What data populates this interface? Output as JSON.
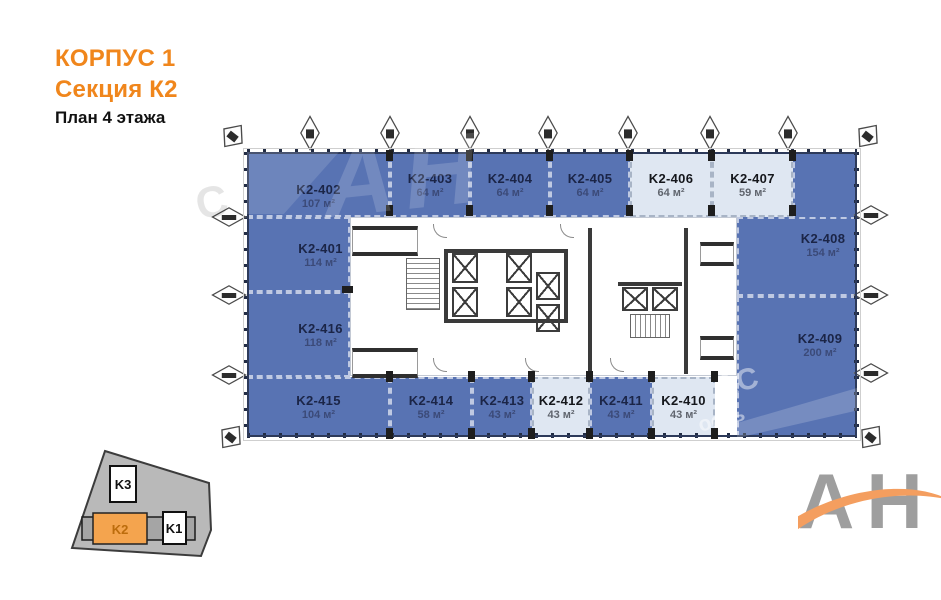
{
  "header": {
    "building": "КОРПУС 1",
    "section": "Секция К2",
    "floor": "План 4 этажа"
  },
  "plan": {
    "area_unit": "м²",
    "rooms": [
      {
        "number": "K2-401",
        "area": "114 м²",
        "light": false
      },
      {
        "number": "K2-402",
        "area": "107 м²",
        "light": false
      },
      {
        "number": "K2-403",
        "area": "64 м²",
        "light": false
      },
      {
        "number": "K2-404",
        "area": "64 м²",
        "light": false
      },
      {
        "number": "K2-405",
        "area": "64 м²",
        "light": false
      },
      {
        "number": "K2-406",
        "area": "64 м²",
        "light": true
      },
      {
        "number": "K2-407",
        "area": "59 м²",
        "light": true
      },
      {
        "number": "K2-408",
        "area": "154 м²",
        "light": false
      },
      {
        "number": "K2-409",
        "area": "200 м²",
        "light": false
      },
      {
        "number": "K2-410",
        "area": "43 м²",
        "light": true
      },
      {
        "number": "K2-411",
        "area": "43 м²",
        "light": false
      },
      {
        "number": "K2-412",
        "area": "43 м²",
        "light": true
      },
      {
        "number": "K2-413",
        "area": "43 м²",
        "light": false
      },
      {
        "number": "K2-414",
        "area": "58 м²",
        "light": false
      },
      {
        "number": "K2-415",
        "area": "104 м²",
        "light": false
      },
      {
        "number": "K2-416",
        "area": "118 м²",
        "light": false
      }
    ]
  },
  "site_plan": {
    "buildings": [
      {
        "label": "K3",
        "highlighted": false
      },
      {
        "label": "K2",
        "highlighted": true
      },
      {
        "label": "K1",
        "highlighted": false
      }
    ]
  },
  "watermark": {
    "big": "АН",
    "c": "С",
    "frag_1": "АС",
    "frag_2": "ость"
  },
  "logo": {
    "text": "АН"
  },
  "colors": {
    "accent_orange": "#F0861C",
    "room_blue": "#5873B3",
    "room_light": "#DFE7F2",
    "site_highlight_orange": "#F4A44E",
    "logo_gray": "#9E9E9E",
    "logo_swoosh_orange": "#F49E5F"
  }
}
